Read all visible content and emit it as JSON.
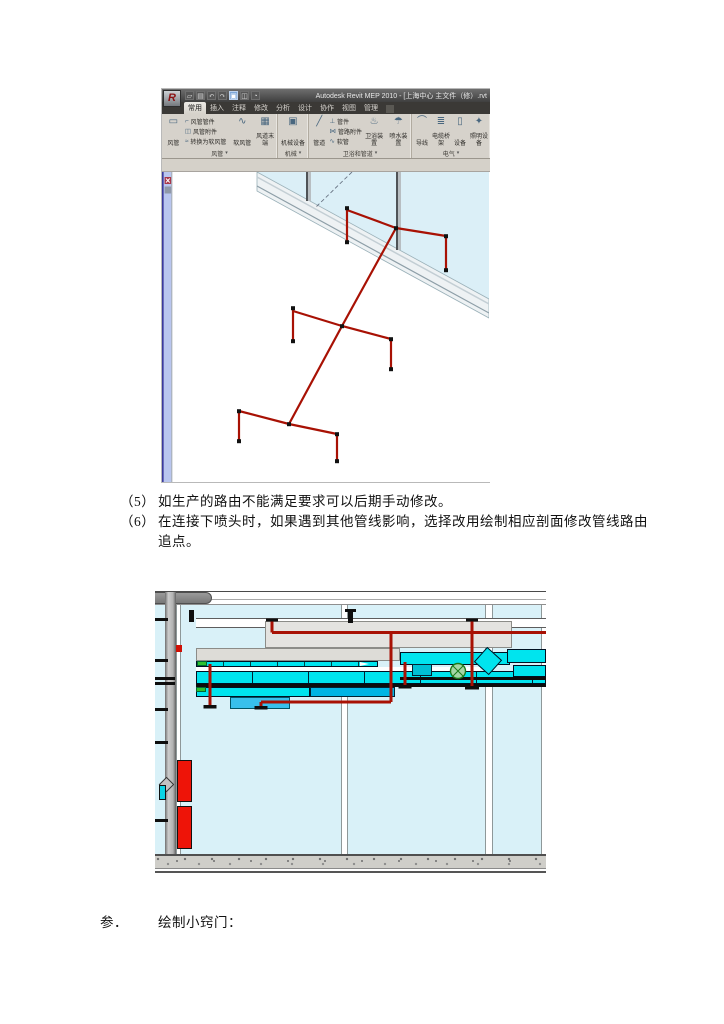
{
  "document": {
    "list_items": [
      {
        "num": "（5）",
        "text": "如生产的路由不能满足要求可以后期手动修改。"
      },
      {
        "num": "（6）",
        "text": "在连接下喷头时，如果遇到其他管线影响，选择改用绘制相应剖面修改管线路由",
        "text_cont": "追点。"
      }
    ],
    "heading": {
      "num": "参．",
      "text": "绘制小窍门："
    }
  },
  "revit": {
    "title": "Autodesk Revit MEP 2010 - [上海中心 主文件（修）.rvt",
    "logo_letter": "R",
    "qat_icons": [
      {
        "name": "open-icon",
        "glyph": "▱"
      },
      {
        "name": "save-icon",
        "glyph": "▤"
      },
      {
        "name": "undo-icon",
        "glyph": "↶"
      },
      {
        "name": "redo-icon",
        "glyph": "↷"
      },
      {
        "name": "selection-icon",
        "glyph": "▣"
      },
      {
        "name": "3d-view-icon",
        "glyph": "◫"
      },
      {
        "name": "render-icon",
        "glyph": "◔"
      }
    ],
    "tabs": [
      "常用",
      "插入",
      "注释",
      "修改",
      "分析",
      "设计",
      "协作",
      "视图",
      "管理"
    ],
    "ribbon_panels": [
      {
        "label": "风管",
        "dropdown": "▾",
        "buttons": [
          {
            "label": "风管",
            "glyph": "▭"
          },
          {
            "label": "风管管件",
            "glyph": "⌐"
          },
          {
            "label": "风管附件",
            "glyph": "◫"
          },
          {
            "label": "转换为软风管",
            "glyph": "≈"
          },
          {
            "label": "软风管",
            "glyph": "∿"
          },
          {
            "label": "风道末端",
            "glyph": "▦"
          }
        ]
      },
      {
        "label": "机械",
        "dropdown": "▾",
        "buttons": [
          {
            "label": "机械设备",
            "glyph": "▣"
          }
        ]
      },
      {
        "label": "卫浴和管道",
        "dropdown": "▾",
        "buttons": [
          {
            "label": "管道",
            "glyph": "╱"
          },
          {
            "label": "管件",
            "glyph": "⊥"
          },
          {
            "label": "管路附件",
            "glyph": "⋈"
          },
          {
            "label": "软管",
            "glyph": "∿"
          },
          {
            "label": "卫浴装置",
            "glyph": "♨"
          },
          {
            "label": "喷水装置",
            "glyph": "☂"
          }
        ]
      },
      {
        "label": "电气",
        "dropdown": "▾",
        "buttons": [
          {
            "label": "导线",
            "glyph": "⌒"
          },
          {
            "label": "电缆桥架",
            "glyph": "≣"
          },
          {
            "label": "设备",
            "glyph": "▯"
          },
          {
            "label": "照明设备",
            "glyph": "✦"
          }
        ]
      }
    ]
  },
  "colors": {
    "pipe_red": "#A81104",
    "duct_cyan": "#00E4EE",
    "glass_blue": "#D9F1F8",
    "equipment_red": "#EE1408",
    "valve_green": "#9FD99F",
    "ribbon_bg": "#D6D2CB",
    "titlebar_gray": "#4A4A4A"
  }
}
